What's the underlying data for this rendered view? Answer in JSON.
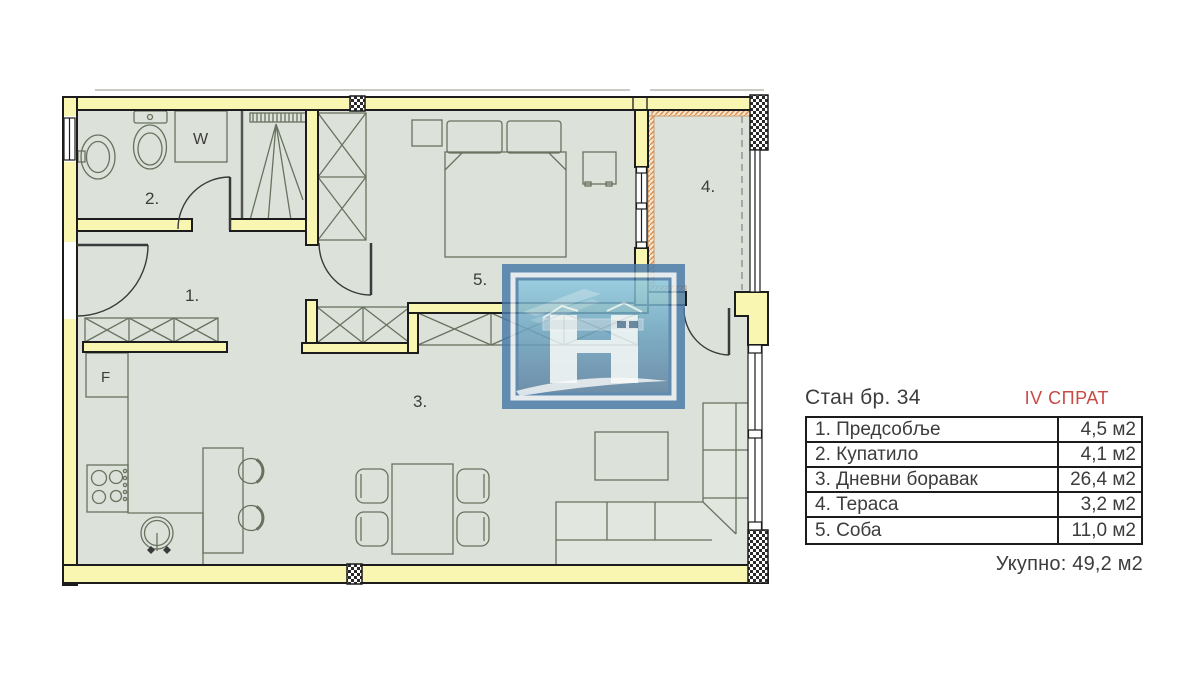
{
  "panel": {
    "title": "Стан бр. 34",
    "floor": "IV СПРАТ",
    "rows": [
      {
        "name": "1. Предсобље",
        "area": "4,5 м2"
      },
      {
        "name": "2. Купатило",
        "area": "4,1 м2"
      },
      {
        "name": "3. Дневни боравак",
        "area": "26,4 м2"
      },
      {
        "name": "4. Тераса",
        "area": "3,2 м2"
      },
      {
        "name": "5. Соба",
        "area": "11,0 м2"
      }
    ],
    "total": "Укупно: 49,2 м2"
  },
  "plan": {
    "labels": {
      "room1": "1.",
      "room2": "2.",
      "room3": "3.",
      "room4": "4.",
      "room5": "5.",
      "washer": "W",
      "fridge": "F"
    }
  },
  "colors": {
    "accent_red": "#c94a43",
    "wall_yellow": "#f9f6b2",
    "floor_green": "#dce2da",
    "line_dark": "#1c1c1c",
    "furniture_line": "#68725f",
    "logo_blue": "#4b7ba8",
    "terrace_hatch_orange": "#d98e4e"
  }
}
